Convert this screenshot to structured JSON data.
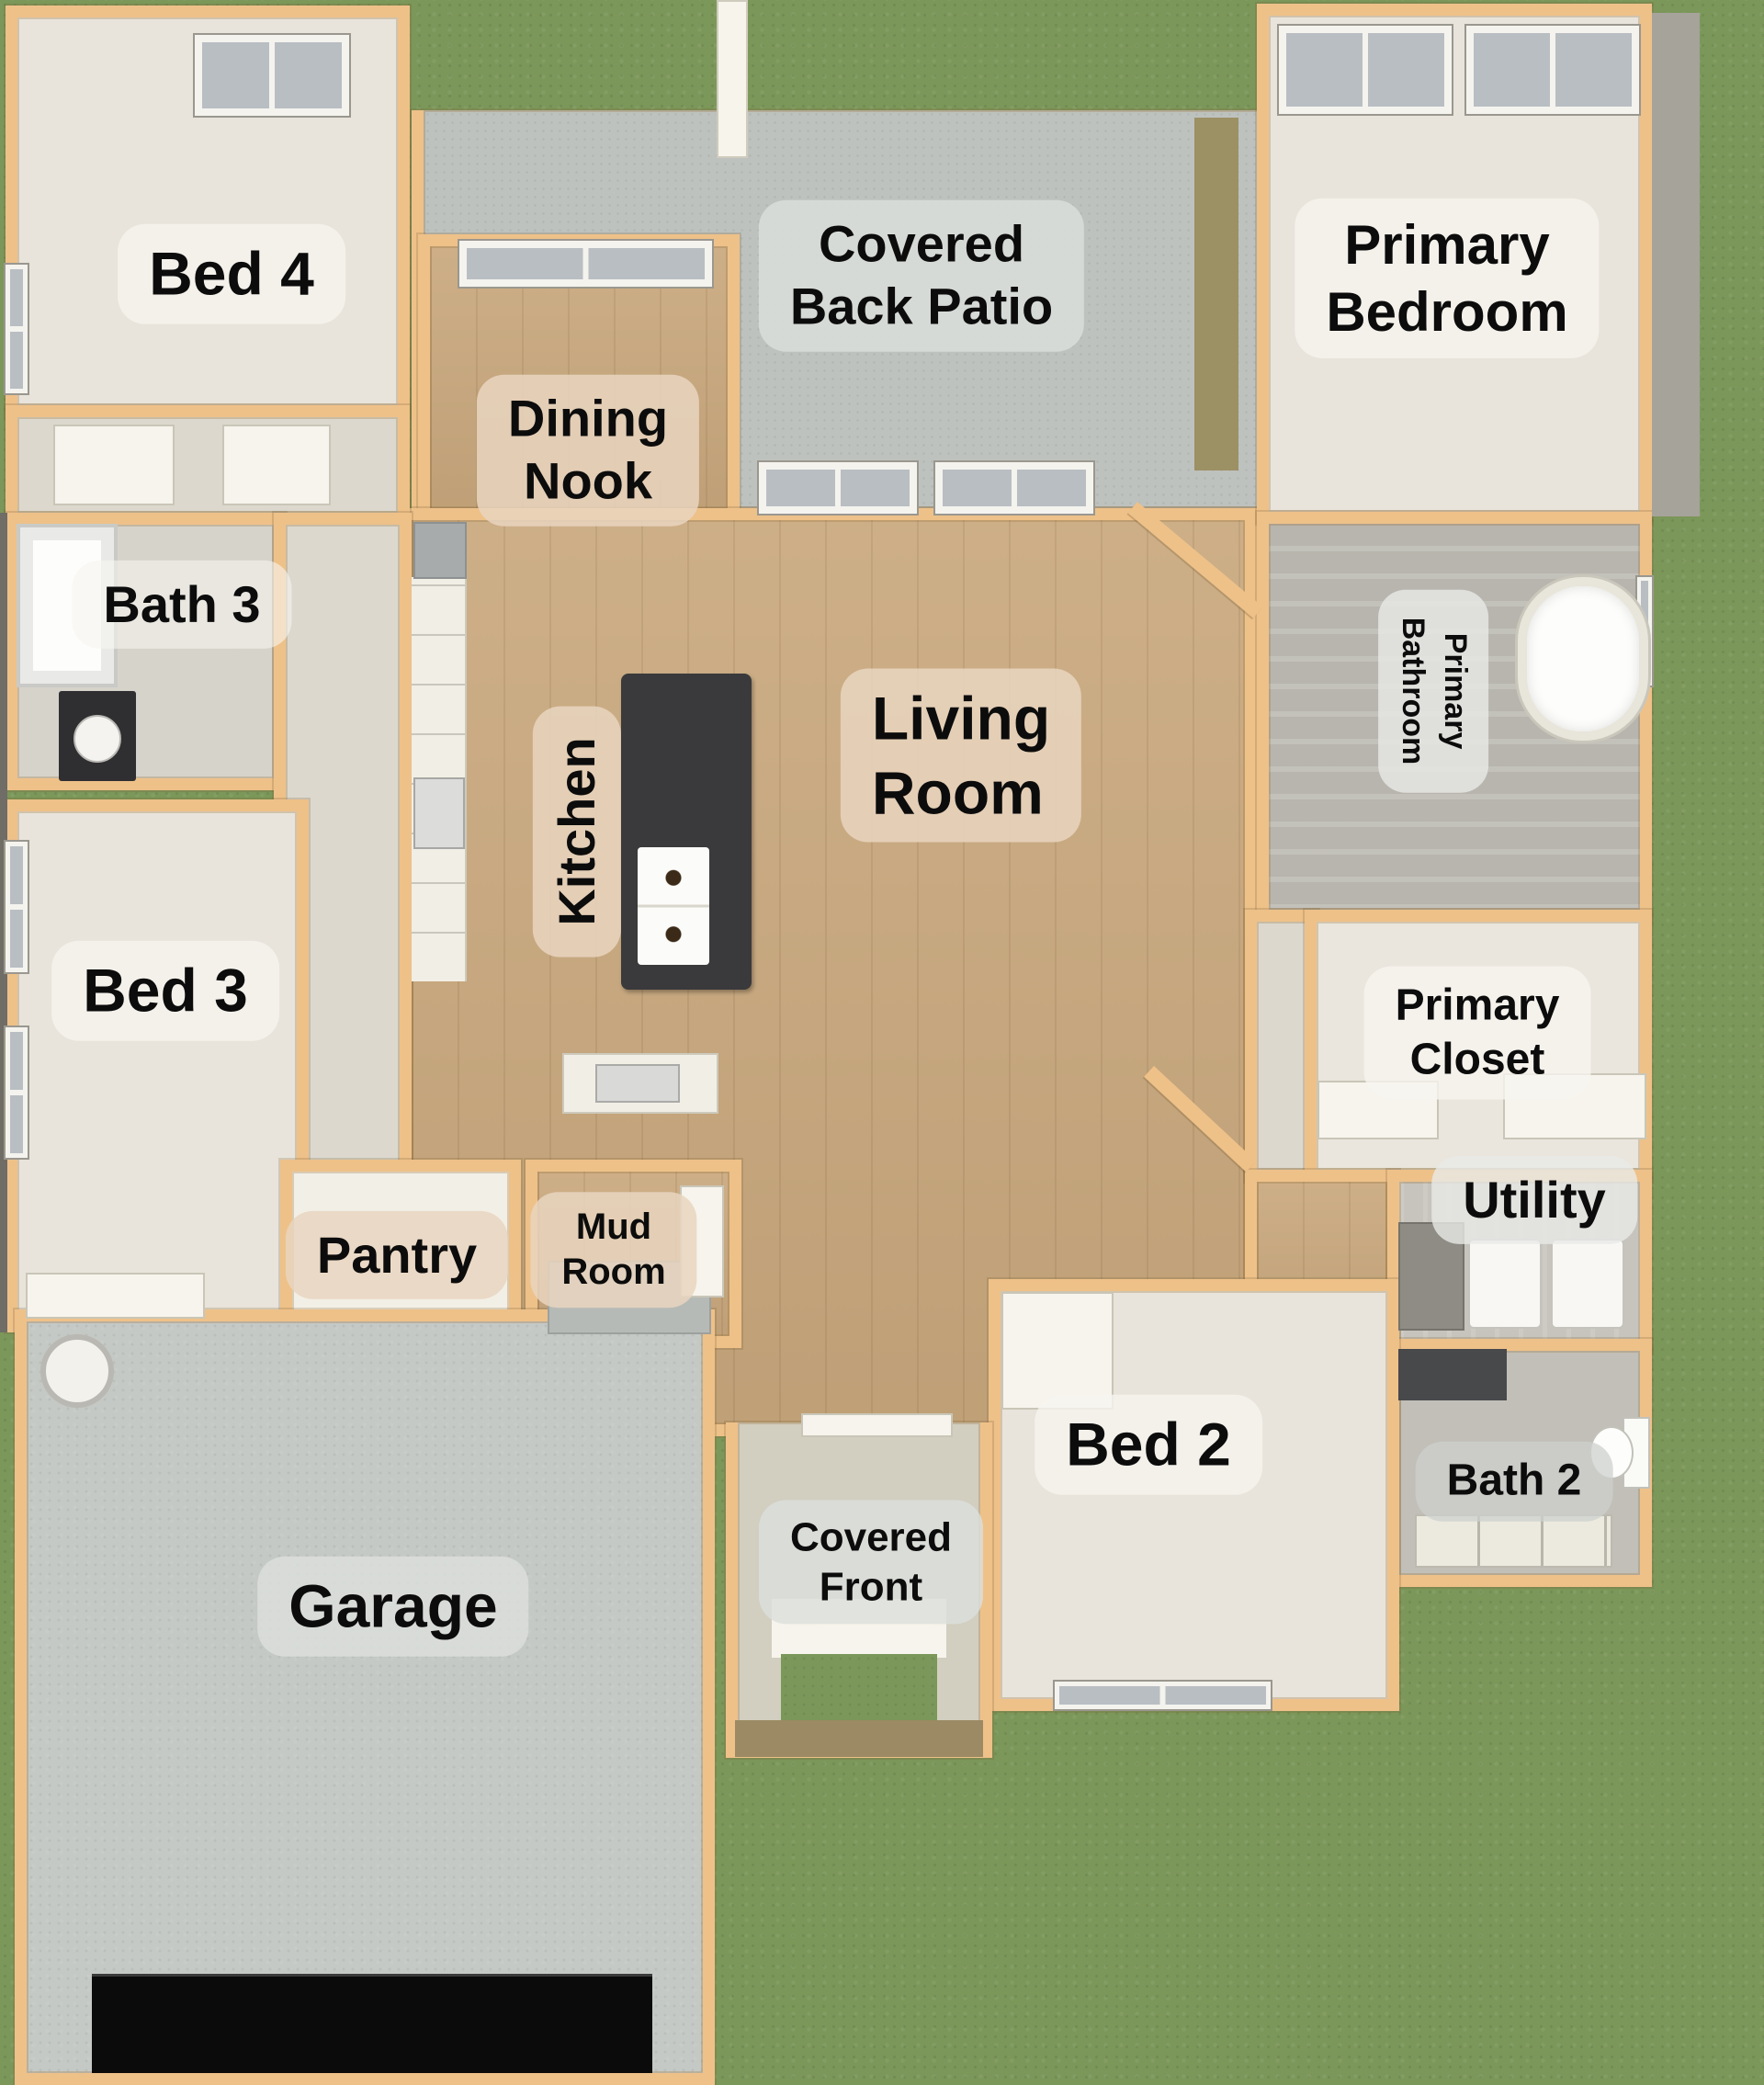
{
  "plan_title": "Single-story house floor plan, 3D top view",
  "palette": {
    "lawn_green": "#7b9759",
    "wall_tan": "#eec189",
    "wood_floor": "#c9a87d",
    "carpet_beige": "#e8e4db",
    "patio_concrete": "#bec2be",
    "garage_concrete": "#c5c9c5",
    "tile_gray": "#b7b5ad",
    "island_charcoal": "#3a3a3c",
    "label_text": "#0c0c0c"
  },
  "rooms": {
    "bed4": {
      "label": "Bed 4"
    },
    "covered_back_patio": {
      "label": "Covered\nBack Patio"
    },
    "primary_bedroom": {
      "label": "Primary\nBedroom"
    },
    "dining_nook": {
      "label": "Dining\nNook"
    },
    "bath3": {
      "label": "Bath 3"
    },
    "kitchen": {
      "label": "Kitchen"
    },
    "living_room": {
      "label": "Living\nRoom"
    },
    "primary_bathroom": {
      "label": "Primary\nBathroom"
    },
    "bed3": {
      "label": "Bed 3"
    },
    "primary_closet": {
      "label": "Primary\nCloset"
    },
    "pantry": {
      "label": "Pantry"
    },
    "mud_room": {
      "label": "Mud\nRoom"
    },
    "utility": {
      "label": "Utility"
    },
    "bed2": {
      "label": "Bed 2"
    },
    "bath2": {
      "label": "Bath 2"
    },
    "garage": {
      "label": "Garage"
    },
    "covered_front": {
      "label": "Covered\nFront"
    }
  }
}
